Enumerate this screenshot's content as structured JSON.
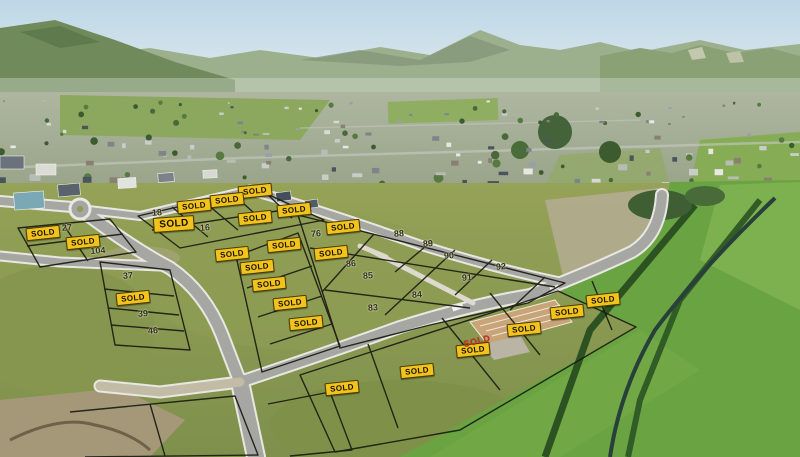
{
  "scene": {
    "type": "aerial-subdivision-photo",
    "colors": {
      "sky_top": "#bdd7e7",
      "sky_horizon": "#e6edef",
      "hills": "#9db08d",
      "grass_subdivision": "#8b9952",
      "paddock_green": "#6aa342",
      "hedge": "#2c5222",
      "road_asphalt": "#a6a6a3",
      "road_kerb": "#e8e7e2",
      "lot_line": "#1b1b12",
      "badge_bg": "#f2c21d",
      "badge_text": "#171200",
      "red_sold_text": "#c62e1e",
      "lot_number_text": "#30301c"
    }
  },
  "overlay": {
    "sold_text": "SOLD",
    "sold_labels": [
      {
        "x": 255,
        "y": 191,
        "variant": "yellow"
      },
      {
        "x": 227,
        "y": 200,
        "variant": "yellow"
      },
      {
        "x": 194,
        "y": 206,
        "variant": "yellow"
      },
      {
        "x": 294,
        "y": 210,
        "variant": "yellow"
      },
      {
        "x": 255,
        "y": 218,
        "variant": "yellow"
      },
      {
        "x": 174,
        "y": 224,
        "variant": "yellow-lg"
      },
      {
        "x": 343,
        "y": 227,
        "variant": "yellow"
      },
      {
        "x": 43,
        "y": 233,
        "variant": "yellow"
      },
      {
        "x": 83,
        "y": 242,
        "variant": "yellow"
      },
      {
        "x": 284,
        "y": 245,
        "variant": "yellow"
      },
      {
        "x": 331,
        "y": 253,
        "variant": "yellow"
      },
      {
        "x": 232,
        "y": 254,
        "variant": "yellow"
      },
      {
        "x": 257,
        "y": 267,
        "variant": "yellow"
      },
      {
        "x": 269,
        "y": 284,
        "variant": "yellow"
      },
      {
        "x": 133,
        "y": 298,
        "variant": "yellow"
      },
      {
        "x": 290,
        "y": 303,
        "variant": "yellow"
      },
      {
        "x": 306,
        "y": 323,
        "variant": "yellow"
      },
      {
        "x": 524,
        "y": 329,
        "variant": "yellow"
      },
      {
        "x": 473,
        "y": 350,
        "variant": "yellow"
      },
      {
        "x": 417,
        "y": 371,
        "variant": "yellow"
      },
      {
        "x": 342,
        "y": 388,
        "variant": "yellow"
      },
      {
        "x": 567,
        "y": 312,
        "variant": "yellow"
      },
      {
        "x": 603,
        "y": 300,
        "variant": "yellow"
      },
      {
        "x": 477,
        "y": 341,
        "variant": "red"
      }
    ],
    "lot_numbers": [
      {
        "label": "27",
        "x": 67,
        "y": 228
      },
      {
        "label": "104",
        "x": 98,
        "y": 251
      },
      {
        "label": "18",
        "x": 157,
        "y": 213
      },
      {
        "label": "16",
        "x": 205,
        "y": 228
      },
      {
        "label": "37",
        "x": 128,
        "y": 276
      },
      {
        "label": "39",
        "x": 143,
        "y": 314
      },
      {
        "label": "46",
        "x": 153,
        "y": 331
      },
      {
        "label": "76",
        "x": 316,
        "y": 234
      },
      {
        "label": "88",
        "x": 399,
        "y": 234
      },
      {
        "label": "89",
        "x": 428,
        "y": 244
      },
      {
        "label": "90",
        "x": 449,
        "y": 256
      },
      {
        "label": "92",
        "x": 501,
        "y": 267
      },
      {
        "label": "86",
        "x": 351,
        "y": 264
      },
      {
        "label": "85",
        "x": 368,
        "y": 276
      },
      {
        "label": "91",
        "x": 467,
        "y": 278
      },
      {
        "label": "84",
        "x": 417,
        "y": 295
      },
      {
        "label": "83",
        "x": 373,
        "y": 308
      }
    ]
  }
}
